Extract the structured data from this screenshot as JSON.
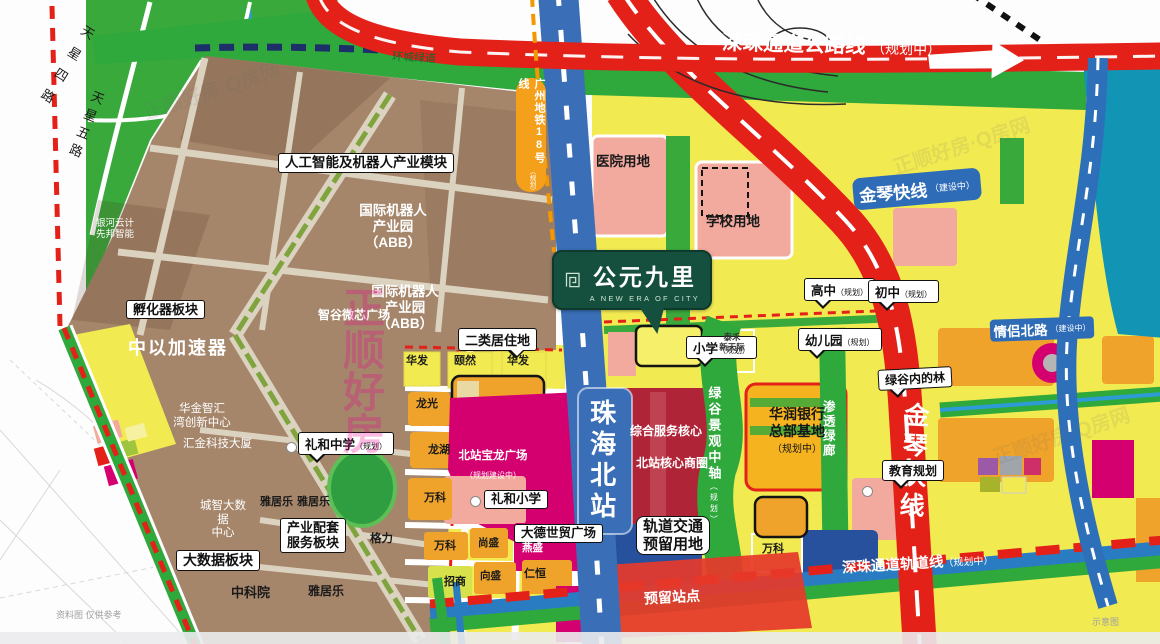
{
  "logo": {
    "title": "公元九里",
    "tagline": "A NEW ERA OF CITY"
  },
  "roads": {
    "shenzhu_highway": {
      "name": "深珠通道公路线",
      "status": "（规划中）"
    },
    "jinqin_pill": {
      "name": "金琴快线",
      "status": "（建设中）"
    },
    "jinqin_road": "金琴快线",
    "metro18": {
      "name": "广州地铁18号线",
      "status": "（规划）"
    },
    "station": "珠海北站",
    "qinglv": {
      "name": "情侣北路",
      "status": "（建设中）"
    },
    "shenzhu_rail": {
      "name": "深珠通道轨道线",
      "status": "（规划中）"
    },
    "reserved_station": "预留站点",
    "tianxing4": "天星四路",
    "tianxing5": "天星五路",
    "greenway": "环城绿道",
    "green_axis": {
      "name": "绿谷景观中轴",
      "status": "（规划）"
    },
    "green_corridor": "渗透绿廊"
  },
  "areas": {
    "hospital": "医院用地",
    "school": "学校用地",
    "ai_robot": "人工智能及机器人产业模块",
    "intl_robot": "国际机器人\n产业园（ABB）",
    "galaxy": "银河云计\n先邦智能",
    "incubator": "孵化器板块",
    "accelerator": "中以加速器",
    "zhigu": "智谷微芯广场",
    "huajin": "华金智汇\n湾创新中心",
    "huijin": "汇金科技大厦",
    "bigdata_center": "城智大数据\n中心",
    "bigdata_block": "大数据板块",
    "cas": "中科院",
    "industry_support": "产业配套\n服务板块",
    "service_core": "综合服务核心",
    "core_business": "北站核心商圈",
    "crbank": {
      "name": "华润银行\n总部基地",
      "status": "（规划中）"
    },
    "baolong": {
      "name": "北站宝龙广场",
      "status": "（规划建设中）"
    },
    "rail_reserved": "轨道交通\n预留用地",
    "residential2": "二类居住地",
    "green_valley": "绿谷内的林",
    "education": "教育规划"
  },
  "bubbles": {
    "lihe_middle": {
      "name": "礼和中学",
      "status": "（规划）"
    },
    "lihe_primary": "礼和小学",
    "dade": "大德世贸广场",
    "primary": {
      "name": "小学",
      "status": "（规划）"
    },
    "kindergarten": {
      "name": "幼儿园",
      "status": "（规划）"
    },
    "high": {
      "name": "高中",
      "status": "（规划）"
    },
    "junior": {
      "name": "初中",
      "status": "（规划）"
    }
  },
  "parcels": {
    "huafa": "华发",
    "yiran": "颐然",
    "huafa2": "华发",
    "longguang": "龙光",
    "longhu": "龙湖",
    "vanke": "万科",
    "vanke2": "万科",
    "vanke3": "万科",
    "shangsheng": "尚盛",
    "yansheng": "燕盛",
    "zhaoshang": "招商",
    "xiangsheng": "向盛",
    "renheng": "仁恒",
    "gree": "格力",
    "yajule": "雅居乐",
    "yajule2": "雅居乐",
    "yajule3": "雅居乐",
    "taihe": "泰禾\n新天际"
  },
  "watermarks": {
    "big": "正顺好房",
    "small": "正顺好房·Q房网"
  },
  "captions": {
    "left": "资料图 仅供参考",
    "right": "示意图"
  },
  "colors": {
    "road_red": "#e32119",
    "rail_blue": "#3a6fb7",
    "metro_orange": "#f39800",
    "green": "#2fa83c",
    "brown": "#a5866b",
    "yellow": "#f2ea51",
    "magenta": "#d5006f",
    "water": "#1294b5",
    "logo_green": "#15503e"
  }
}
